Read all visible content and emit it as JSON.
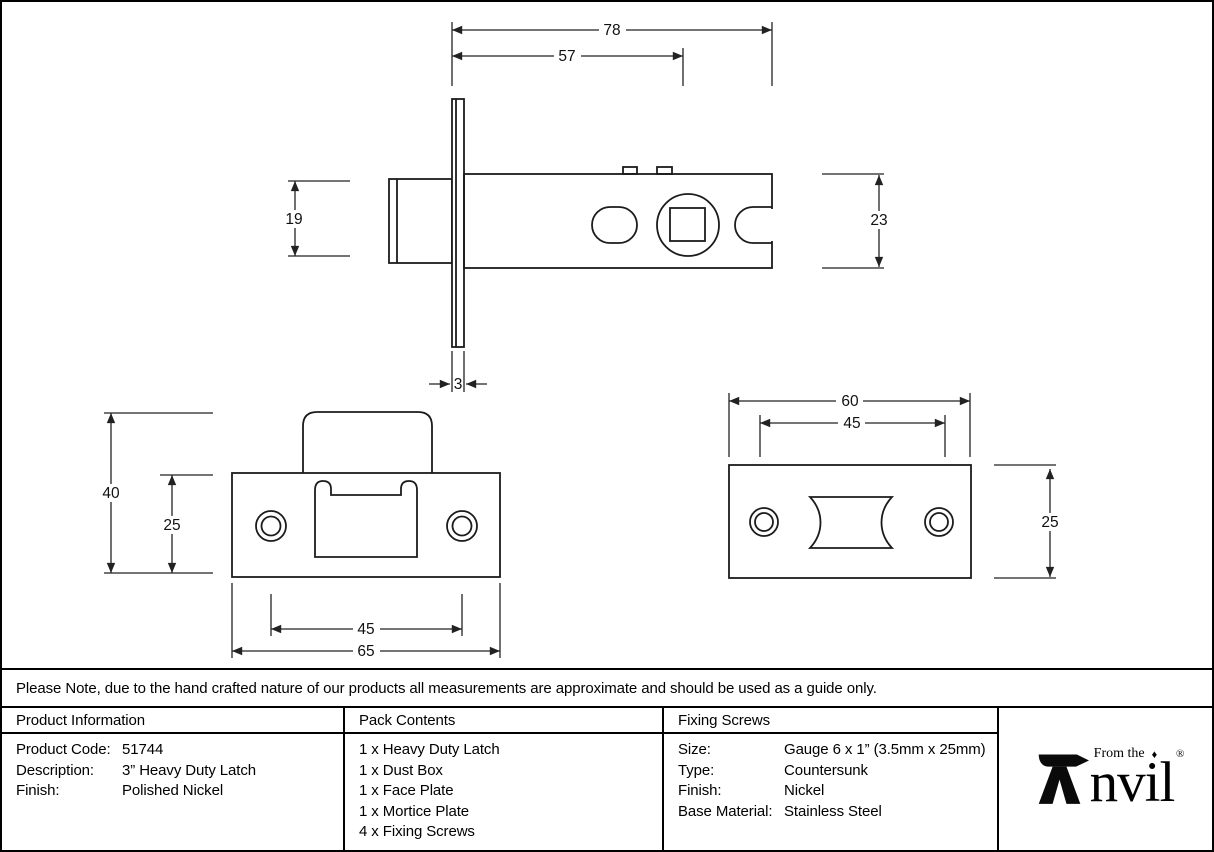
{
  "note": "Please Note, due to the hand crafted nature of our products all measurements are approximate and should be used as a guide only.",
  "drawing": {
    "latch_dims": {
      "overall_length": "78",
      "case_depth": "57",
      "bolt_height": "19",
      "case_height": "23",
      "faceplate_thickness": "3"
    },
    "strike_dims": {
      "overall_height": "40",
      "plate_height": "25",
      "screw_spacing": "45",
      "overall_width": "65"
    },
    "faceplate_dims": {
      "overall_width": "60",
      "screw_spacing": "45",
      "plate_height": "25"
    }
  },
  "table": {
    "product_info": {
      "header": "Product Information",
      "rows": [
        [
          "Product Code:",
          "51744"
        ],
        [
          "Description:",
          "3” Heavy Duty Latch"
        ],
        [
          "Finish:",
          "Polished Nickel"
        ]
      ]
    },
    "pack_contents": {
      "header": "Pack Contents",
      "items": [
        "1 x Heavy Duty Latch",
        "1 x Dust Box",
        "1 x Face Plate",
        "1 x Mortice Plate",
        "4 x Fixing Screws"
      ]
    },
    "fixing_screws": {
      "header": "Fixing Screws",
      "rows": [
        [
          "Size:",
          "Gauge 6 x 1” (3.5mm x 25mm)"
        ],
        [
          "Type:",
          "Countersunk"
        ],
        [
          "Finish:",
          "Nickel"
        ],
        [
          "Base Material:",
          "Stainless Steel"
        ]
      ]
    }
  },
  "logo": {
    "tagline": "From the",
    "diamond": "♦",
    "word_remainder": "nvil",
    "registered": "®"
  }
}
